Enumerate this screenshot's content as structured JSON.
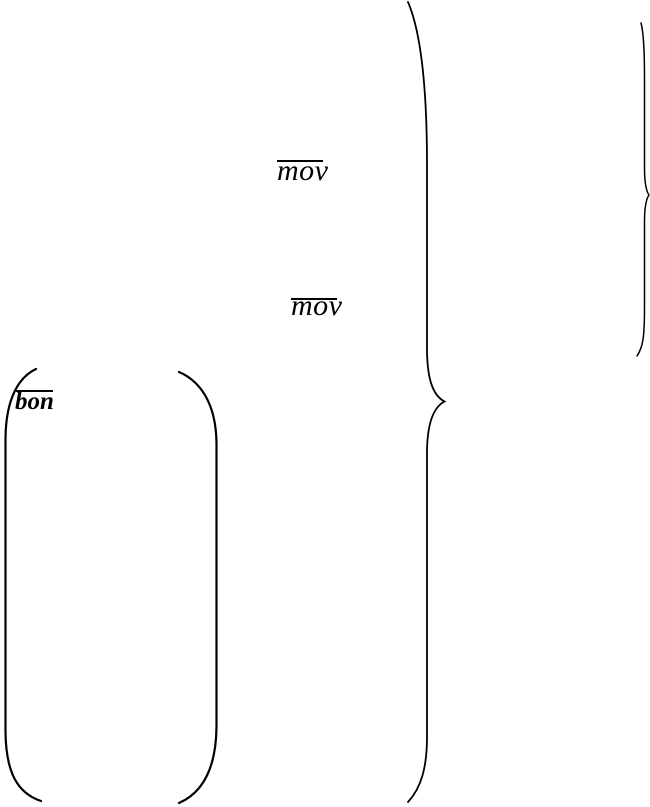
{
  "page": {
    "background_color": "#ffffff",
    "ink_color": "#000000",
    "description": "Fragment of a typeset mathematical expression with overlined variables and large delimiters"
  },
  "labels": {
    "mov_top": {
      "text": "mov",
      "overline": true
    },
    "mov_middle": {
      "text": "mov",
      "overline": true
    },
    "bon": {
      "text": "bon",
      "overline": true
    }
  },
  "symbols": {
    "large_right_brace": {
      "glyph": "}",
      "span_y": [
        2,
        802
      ]
    },
    "small_right_brace": {
      "glyph": "}",
      "span_y": [
        23,
        356
      ]
    },
    "left_parenthesis": {
      "glyph": "(",
      "span_y": [
        369,
        801
      ]
    },
    "right_parenthesis": {
      "glyph": ")",
      "span_y": [
        372,
        803
      ]
    }
  }
}
